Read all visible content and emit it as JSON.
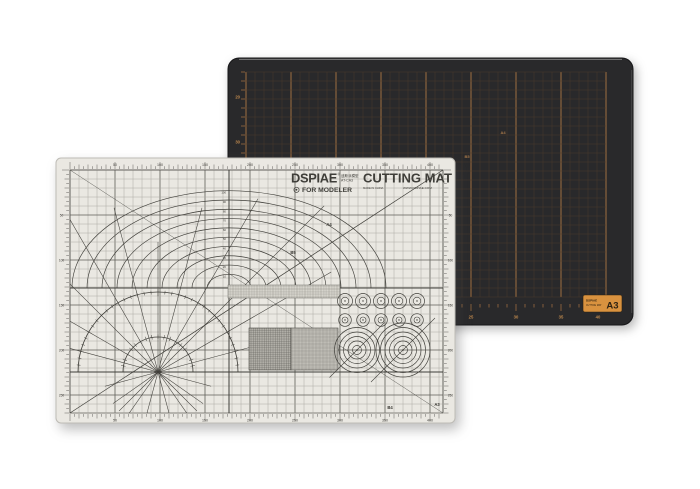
{
  "scene": {
    "background": "#ffffff"
  },
  "black_mat": {
    "colors": {
      "body": "#29292b",
      "border": "#161618",
      "grid_minor": "#4e3d2c",
      "grid_major": "#bf8047",
      "label": "#c08a4e",
      "edge_highlight": "#9a9a9a"
    },
    "left_ruler_labels": [
      "20",
      "30"
    ],
    "bottom_ruler_labels": [
      "25",
      "30",
      "35",
      "40"
    ],
    "area_labels": [
      {
        "text": "A4"
      },
      {
        "text": "B5"
      }
    ],
    "badge": {
      "brand": "DSPIAE",
      "product": "CUTTING MAT",
      "size": "A3",
      "bg": "#d9923f",
      "fg": "#2e2212"
    }
  },
  "white_mat": {
    "colors": {
      "body": "#eae8e2",
      "rim": "#bdbbb5",
      "grid_minor": "#a7a59e",
      "grid_major": "#5f5e58",
      "ink": "#3f3e39"
    },
    "header": {
      "brand": "DSPIAE",
      "reg": "®",
      "brand_cn": "迪斯派模型",
      "model": "AT-CA3",
      "product": "CUTTING MAT",
      "tagline": "FOR MODELER",
      "made": "MADE IN CHINA",
      "website": "WWW.DSPIAE.COM"
    },
    "top_ruler_labels": [
      "50",
      "100",
      "150",
      "200",
      "250",
      "300",
      "350",
      "400"
    ],
    "bottom_ruler_labels": [
      "50",
      "100",
      "150",
      "200",
      "250",
      "300",
      "350",
      "400"
    ],
    "left_ruler_labels": [
      "50",
      "100",
      "150",
      "200",
      "250"
    ],
    "right_ruler_labels": [
      "50",
      "100",
      "150",
      "200",
      "250"
    ],
    "arc_labels": [
      "10",
      "20",
      "30",
      "40",
      "50",
      "60",
      "70",
      "80",
      "90",
      "100"
    ],
    "size_labels": [
      {
        "text": "A4"
      },
      {
        "text": "B5"
      },
      {
        "text": "B4"
      },
      {
        "text": "A3"
      }
    ]
  }
}
